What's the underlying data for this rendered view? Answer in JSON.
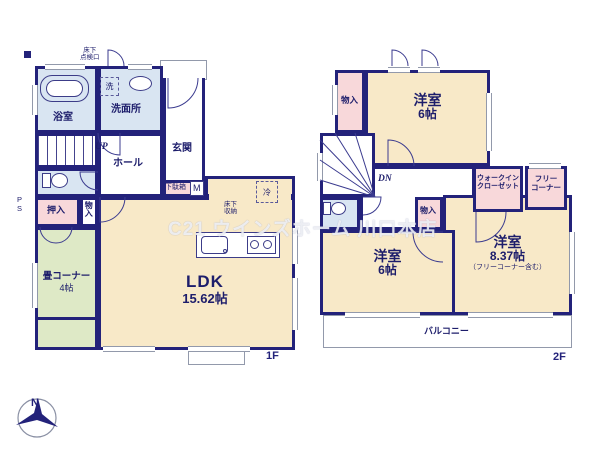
{
  "watermark": "C21 ウインズホーム 川口本店",
  "compass": {
    "north_label": "N"
  },
  "colors": {
    "wall": "#23227a",
    "room_cream": "#f8e9c8",
    "closet_pink": "#f8d8da",
    "tatami_green": "#dee9c6",
    "wet_area_blue": "#d9e5f2"
  },
  "floor1": {
    "floor_label": "1F",
    "hatch_label": "床下\n点検口",
    "bath": "浴室",
    "laundry": "洗",
    "washroom": "洗面所",
    "entrance": "玄関",
    "shoe_cabinet": "下駄箱",
    "shoe_cabinet_tag": "M",
    "stairs_up": "UP",
    "hall": "ホール",
    "pipe_space": "P\nS",
    "oshiire": "押入",
    "storage": "物入",
    "tatami": "畳コーナー",
    "tatami_size": "4帖",
    "ldk": "LDK",
    "ldk_size": "15.62帖",
    "fridge": "冷",
    "underfloor_storage": "床下\n収納"
  },
  "floor2": {
    "floor_label": "2F",
    "storage_north": "物入",
    "bedroom_north": "洋室",
    "bedroom_north_size": "6帖",
    "stairs_down": "DN",
    "storage_mid": "物入",
    "wic": "ウォークイン\nクローゼット",
    "free_corner": "フリー\nコーナー",
    "bedroom_sw": "洋室",
    "bedroom_sw_size": "6帖",
    "bedroom_se": "洋室",
    "bedroom_se_size": "8.37帖",
    "bedroom_se_note": "（フリーコーナー含む）",
    "balcony": "バルコニー"
  }
}
